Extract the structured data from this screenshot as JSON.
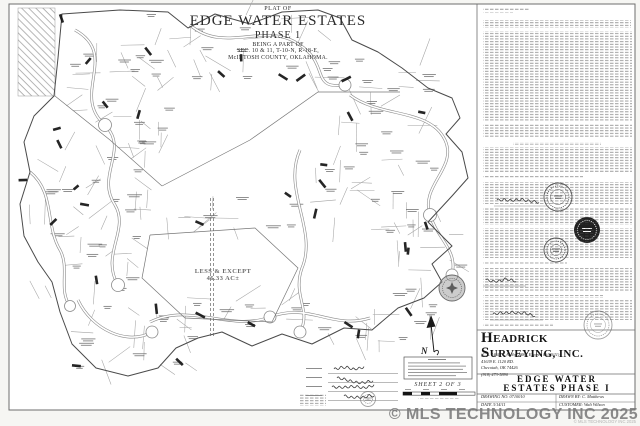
{
  "title_block": {
    "plat_of": "PLAT OF",
    "name": "EDGE WATER ESTATES",
    "phase": "PHASE 1",
    "being_a_part_of": "BEING A PART OF",
    "section_line": "SEC. 10 & 11, T-10-N, R-18-E,",
    "county_line": "McINTOSH COUNTY, OKLAHOMA."
  },
  "map": {
    "less_except_line1": "LESS & EXCEPT",
    "less_except_line2": "46.33 AC±",
    "north_label": "N",
    "sheet_label": "SHEET 2 OF 3"
  },
  "firm_block": {
    "firm_name_line1": "HEADRICK",
    "firm_name_line2": "SURVEYING, INC.",
    "license_line": "(C.A. 1461, C.A. No. 2886, Expires 06/30/11)",
    "address_line1": "41639 E. 1120 RD.",
    "address_line2": "Checotah, OK 74426",
    "phone": "(918) 473-5890",
    "project_line1": "EDGE WATER",
    "project_line2": "ESTATES PHASE I",
    "drawing_no": "DRAWING NO. 0710010",
    "drawn_by": "DRAWN BY: C. Matthews",
    "date": "DATE 3/14/11",
    "customer": "CUSTOMER: Walt Wilson"
  },
  "watermark": {
    "large": "© MLS TECHNOLOGY INC 2025",
    "small": "© MLS TECHNOLOGY INC 2025"
  },
  "colors": {
    "ink": "#3a3a3a",
    "watermark_gray": "#7a7a7a",
    "paper": "#ffffff"
  }
}
